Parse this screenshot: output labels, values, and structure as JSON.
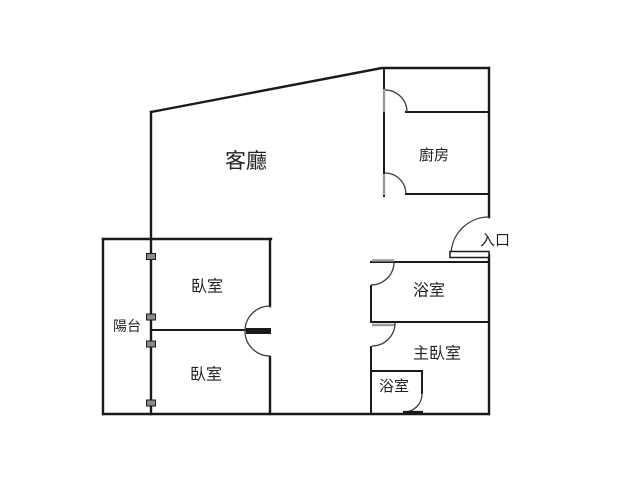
{
  "page": {
    "background": "#ffffff"
  },
  "floor_plan": {
    "type": "apartment-floor-plan",
    "colors": {
      "background": "#ffffff",
      "wall": "#1a1a1a",
      "door_arc": "#3d3d3d",
      "door_leaf": "#9a9a9a",
      "marker_fill": "#8a8a8a",
      "label": "#222222"
    },
    "rooms": {
      "living_room": {
        "label": "客廳"
      },
      "kitchen": {
        "label": "廚房"
      },
      "entrance": {
        "label": "入口"
      },
      "bathroom": {
        "label": "浴室"
      },
      "master_bedroom": {
        "label": "主臥室"
      },
      "master_bathroom": {
        "label": "浴室"
      },
      "bedroom_top": {
        "label": "臥室"
      },
      "bedroom_bottom": {
        "label": "臥室"
      },
      "balcony": {
        "label": "陽台"
      }
    }
  }
}
